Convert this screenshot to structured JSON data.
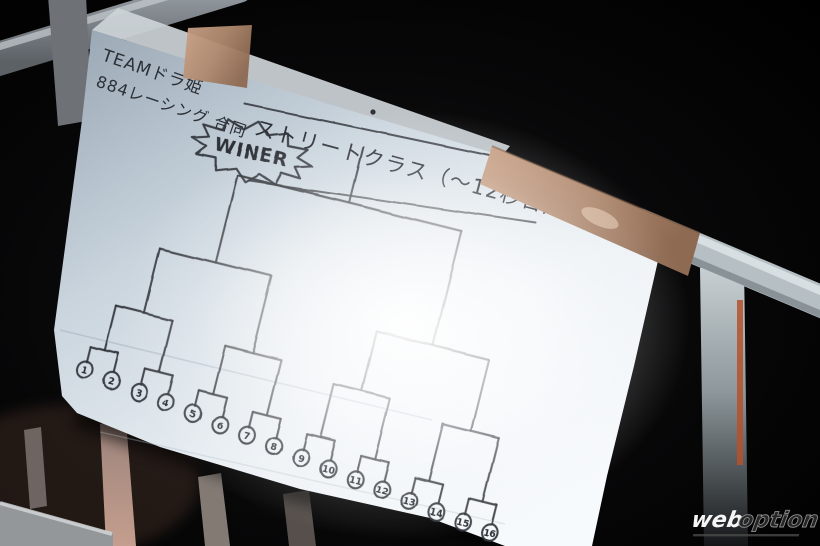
{
  "scene": {
    "team_note": {
      "line1": "TEAMドラ姫",
      "line2": "884レーシング 合同"
    },
    "title": "ストリートクラス（〜12秒台）",
    "winner_label": "WINER",
    "bracket": {
      "type": "single-elimination",
      "num_entries": 16,
      "entries": [
        "1",
        "2",
        "3",
        "4",
        "5",
        "6",
        "7",
        "8",
        "9",
        "10",
        "11",
        "12",
        "13",
        "14",
        "15",
        "16"
      ]
    },
    "watermark": {
      "word1": "web",
      "word2": "option"
    },
    "colors": {
      "background": "#060607",
      "paper": "#eef3f7",
      "ink": "#30343a",
      "tape": "#bd9579",
      "rail": "#b5bfc4",
      "accent_stripe": "#b5512b"
    }
  }
}
